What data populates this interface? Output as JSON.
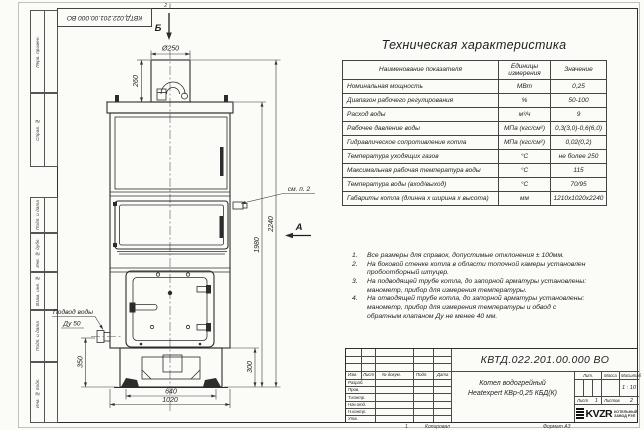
{
  "sheet": {
    "zone_top": "2",
    "zone_bottom": "1",
    "copied_label": "Копировал",
    "format_label": "Формат А3",
    "margin_labels": [
      "Перв. примен.",
      "Справ. №",
      "Подп. и дата",
      "Инв. № дубл.",
      "Взам. инв. №",
      "Подп. и дата",
      "Инв. № подл."
    ]
  },
  "table": {
    "title": "Техническая характеристика",
    "headers": [
      "Наименование показателя",
      "Единицы измерения",
      "Значение"
    ],
    "rows": [
      [
        "Номинальная мощность",
        "МВт",
        "0,25"
      ],
      [
        "Диапазон рабочего регулирования",
        "%",
        "50-100"
      ],
      [
        "Расход воды",
        "м³/ч",
        "9"
      ],
      [
        "Рабочее давление воды",
        "МПа (кгс/см²)",
        "0,3(3,0)-0,6(6,0)"
      ],
      [
        "Гидравлическое сопротивление котла",
        "МПа (кгс/см²)",
        "0,02(0,2)"
      ],
      [
        "Температура уходящих газов",
        "°С",
        "не более 250"
      ],
      [
        "Максимальная рабочая температура воды",
        "°С",
        "115"
      ],
      [
        "Температура воды (вход/выход)",
        "°С",
        "70/95"
      ],
      [
        "Габариты котла (длинна х ширина х высота)",
        "мм",
        "1210х1020х2240"
      ]
    ]
  },
  "notes": [
    {
      "num": "1.",
      "text": "Все размеры для справок, допустимые отклонения ± 100мм."
    },
    {
      "num": "2.",
      "text": "На боковой стенке котла в области топочной камеры установлен пробоотборный штуцер."
    },
    {
      "num": "3.",
      "text": "На подводящей трубе котла, до запорной арматуры установлены: манометр, прибор для измерения температуры."
    },
    {
      "num": "4.",
      "text": "На отводящей трубе котла, до запорной арматуры установлены: манометр, прибор для измерения температуры и обвод с обратным клапаном Ду не менее 40 мм."
    }
  ],
  "drawing": {
    "dims": {
      "chimney_dia": "Ø250",
      "chimney_height": "260",
      "total_height": "2240",
      "body_height": "1980",
      "inlet_height": "350",
      "base_height": "300",
      "base_width": "640",
      "overall_width": "1020"
    },
    "labels": {
      "view_top": "Б",
      "view_front": "А",
      "see_note": "см. п. 2",
      "water_supply_line1": "Подвод воды",
      "water_supply_line2": "Ду 50"
    }
  },
  "title_block": {
    "doc_number": "КВТД.022.201.00.000 ВО",
    "product_name_1": "Котел водогрейный",
    "product_name_2": "Heatexpert КВр-0,25 КБД(К)",
    "cols": [
      "Изм.",
      "Лист",
      "№ докум.",
      "Подп.",
      "Дата"
    ],
    "rows": [
      "Разраб.",
      "Пров.",
      "Т.контр.",
      "Нач.отд.",
      "Н.контр.",
      "Утв."
    ],
    "lit_label": "Лит.",
    "mass_label": "Масса",
    "scale_label": "Масштаб",
    "scale_value": "1 : 10",
    "sheet_label": "Лист",
    "sheet_value": "1",
    "sheets_label": "Листов",
    "sheets_value": "2",
    "logo_text": "KVZR",
    "logo_sub1": "КОТЕЛЬНЫЙ",
    "logo_sub2": "ЗАВОД РЭП"
  }
}
